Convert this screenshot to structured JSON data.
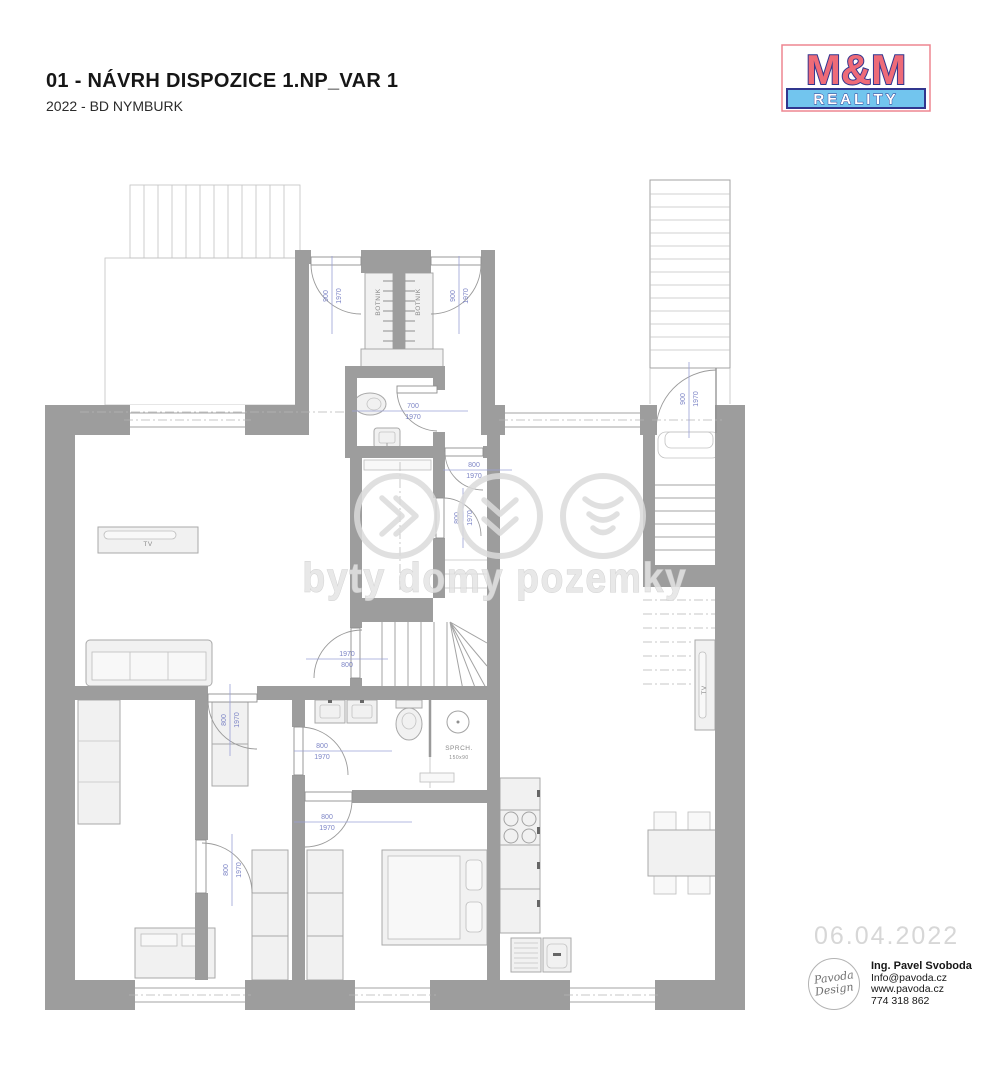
{
  "header": {
    "title": "01 - NÁVRH DISPOZICE 1.NP_VAR 1",
    "subtitle": "2022 - BD NYMBURK"
  },
  "logo": {
    "top": "M&M",
    "bottom": "REALITY",
    "red": "#ee6b78",
    "blue": "#30368f",
    "light_blue": "#72c5ee"
  },
  "watermark": {
    "text": "byty domy pozemky"
  },
  "plan": {
    "labels": {
      "botnik_left": "BOTNIK",
      "botnik_right": "BOTNIK",
      "tv_living": "TV",
      "tv_right": "TV",
      "shower_name": "SPRCH.",
      "shower_size": "150x90"
    },
    "dims": {
      "entry_left_w": "900",
      "entry_left_h": "1970",
      "entry_right_w": "900",
      "entry_right_h": "1970",
      "wc_w": "700",
      "wc_h": "1970",
      "hall_top_w": "800",
      "hall_top_h": "1970",
      "hall_side_w": "800",
      "hall_side_h": "1970",
      "entrance_w": "900",
      "entrance_h": "1970",
      "stairs_w": "1970",
      "stairs_h": "800",
      "room_left_w": "800",
      "room_left_h": "1970",
      "bath_w": "800",
      "bath_h": "1970",
      "bedroom_w": "800",
      "bedroom_h": "1970",
      "closet_w": "800",
      "closet_h": "1970"
    }
  },
  "footer": {
    "date": "06.04.2022",
    "designer": {
      "logo_top": "Pavoda",
      "logo_bottom": "Design",
      "name": "Ing. Pavel Svoboda",
      "email": "Info@pavoda.cz",
      "web": "www.pavoda.cz",
      "phone": "774 318 862"
    }
  }
}
